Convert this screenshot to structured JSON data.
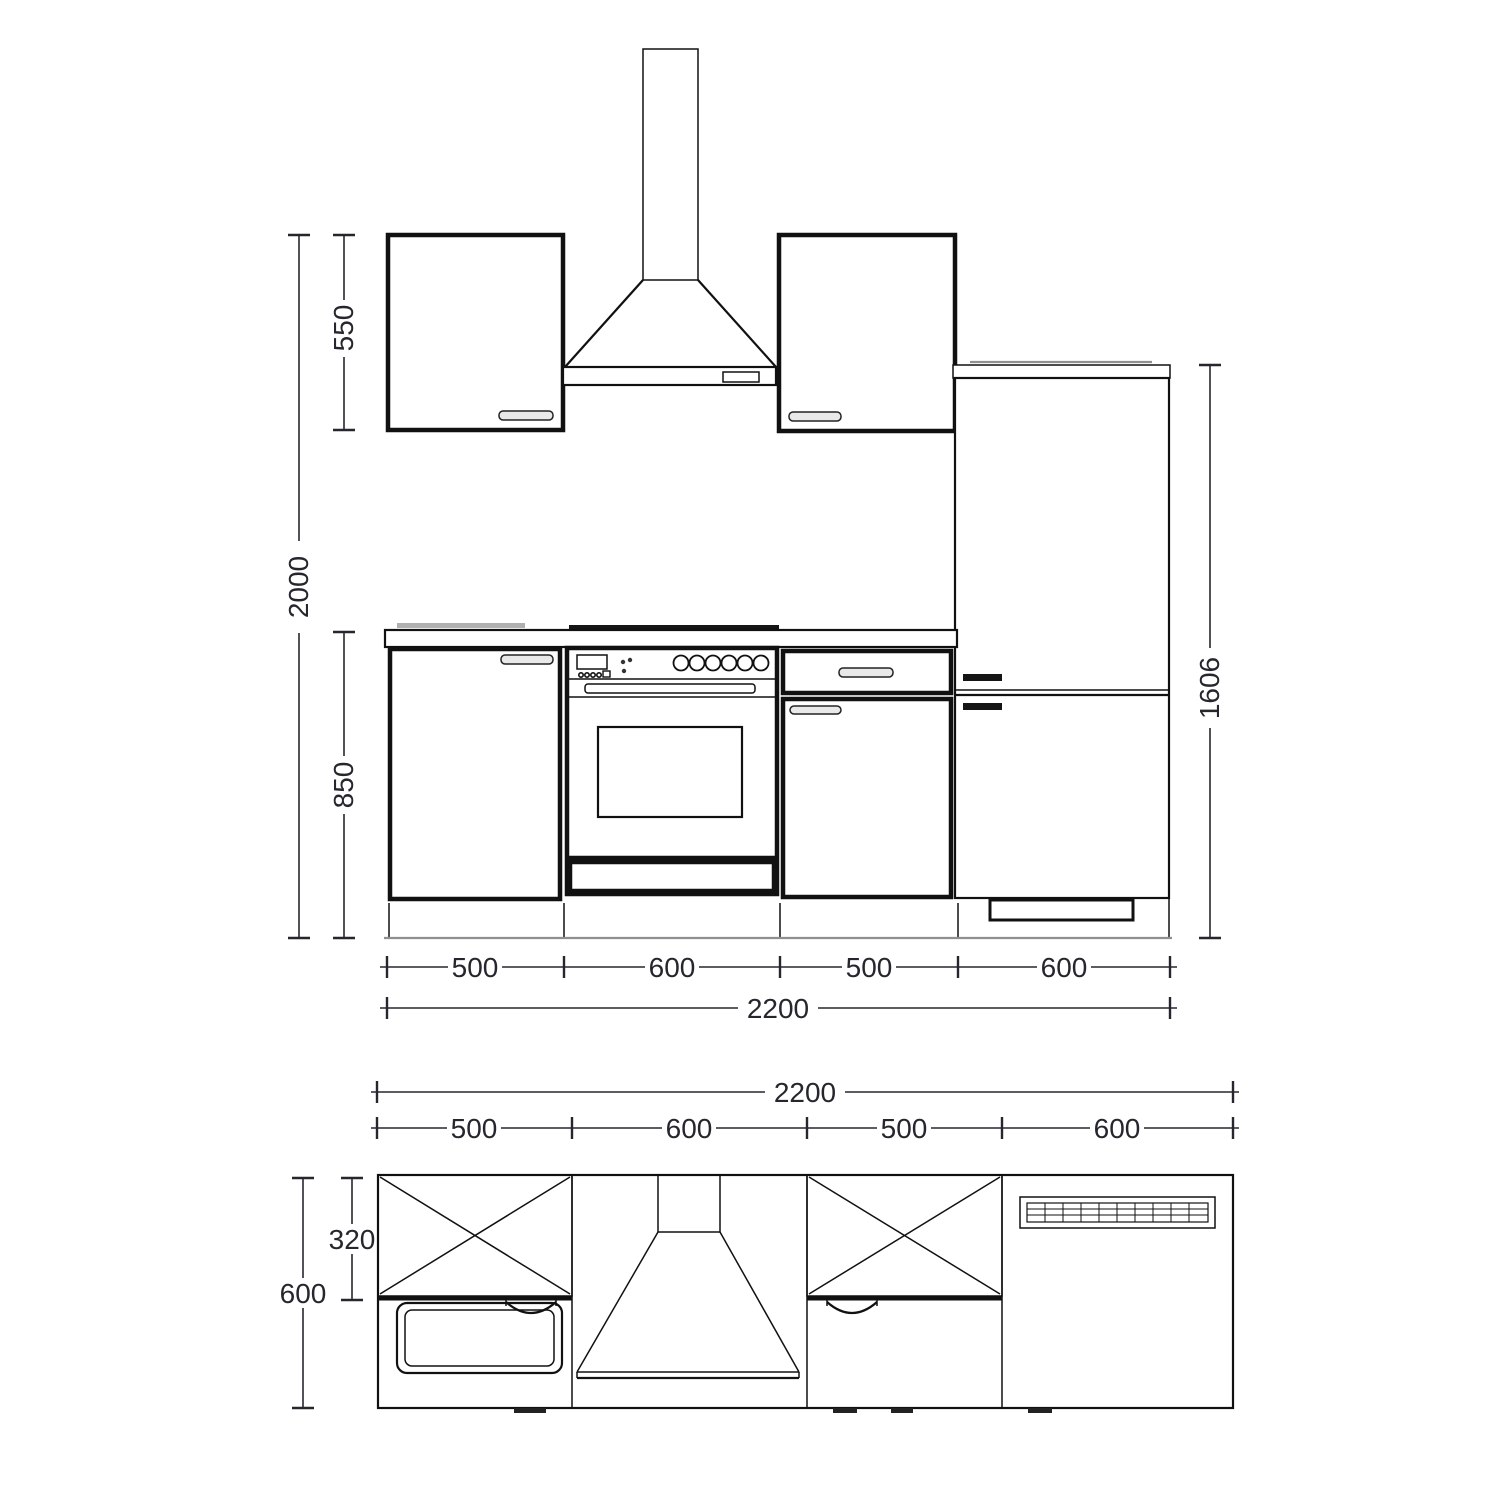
{
  "colors": {
    "line": "#111111",
    "dim_text": "#26262e",
    "gray": "#8f8f8f"
  },
  "elevation": {
    "total_height": "2000",
    "wall_cabinet_height": "550",
    "base_height": "850",
    "fridge_height": "1606",
    "segment_widths": [
      "500",
      "600",
      "500",
      "600"
    ],
    "total_width": "2200"
  },
  "plan": {
    "total_width": "2200",
    "segment_widths": [
      "500",
      "600",
      "500",
      "600"
    ],
    "wall_cabinet_depth": "320",
    "counter_depth": "600"
  }
}
